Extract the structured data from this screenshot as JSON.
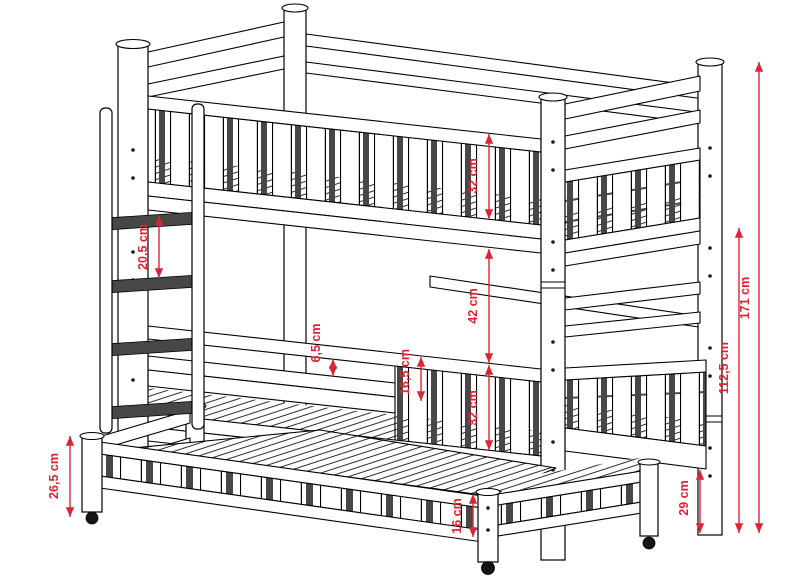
{
  "drawing": {
    "kind": "bunk-bed-with-trundle-technical-drawing",
    "units": "cm"
  },
  "colors": {
    "dim": "#dd2433",
    "outline": "#000000",
    "slat_dark": "#474747",
    "wheel": "#151515"
  },
  "dimensions": [
    {
      "id": "total-height",
      "label": "171 cm"
    },
    {
      "id": "lower-post-height",
      "label": "112,5 cm"
    },
    {
      "id": "rail-to-floor",
      "label": "29 cm"
    },
    {
      "id": "top-guardrail-height",
      "label": "32 cm"
    },
    {
      "id": "bunk-gap",
      "label": "42 cm"
    },
    {
      "id": "middle-guardrail-height",
      "label": "32 cm"
    },
    {
      "id": "guardrail-above-mattress",
      "label": "16,5 cm"
    },
    {
      "id": "rail-gap",
      "label": "6,5 cm"
    },
    {
      "id": "ladder-step",
      "label": "20,5 cm"
    },
    {
      "id": "trundle-height",
      "label": "26,5 cm"
    },
    {
      "id": "trundle-slat-height",
      "label": "16 cm"
    }
  ]
}
